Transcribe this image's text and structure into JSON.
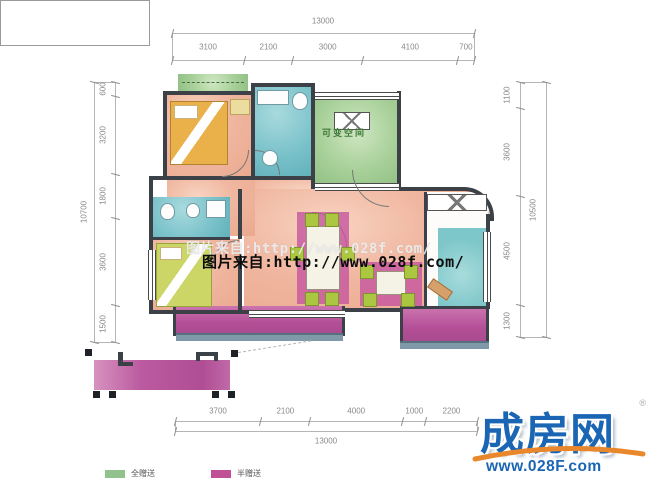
{
  "watermark": {
    "line1": "图片来自:http://www.028f.com/",
    "line2": "图片来自:http://www.028f.com/"
  },
  "plan": {
    "flexible_space_label": "可变空间"
  },
  "dimensions": {
    "top": {
      "total": 13000,
      "segments": [
        3100,
        2100,
        3000,
        4100,
        700
      ]
    },
    "bottom": {
      "total": 13000,
      "segments": [
        3700,
        2100,
        4000,
        1000,
        2200
      ]
    },
    "left": {
      "total": 10700,
      "segments": [
        600,
        3200,
        1800,
        3600,
        1500
      ]
    },
    "right": {
      "total": 10500,
      "segments": [
        1100,
        3600,
        4500,
        1300
      ]
    }
  },
  "legend": {
    "items": [
      {
        "label": "全赠送",
        "color": "#92c28b"
      },
      {
        "label": "半赠送",
        "color": "#c05194"
      }
    ]
  },
  "logo": {
    "name": "成房网",
    "registered": "®",
    "url": "www.028F.com"
  },
  "colors": {
    "wall": "#3b4147",
    "salmon": "#efb29d",
    "green": "#a9d09b",
    "teal": "#7cc3ca",
    "magenta": "#bd5c9f"
  }
}
